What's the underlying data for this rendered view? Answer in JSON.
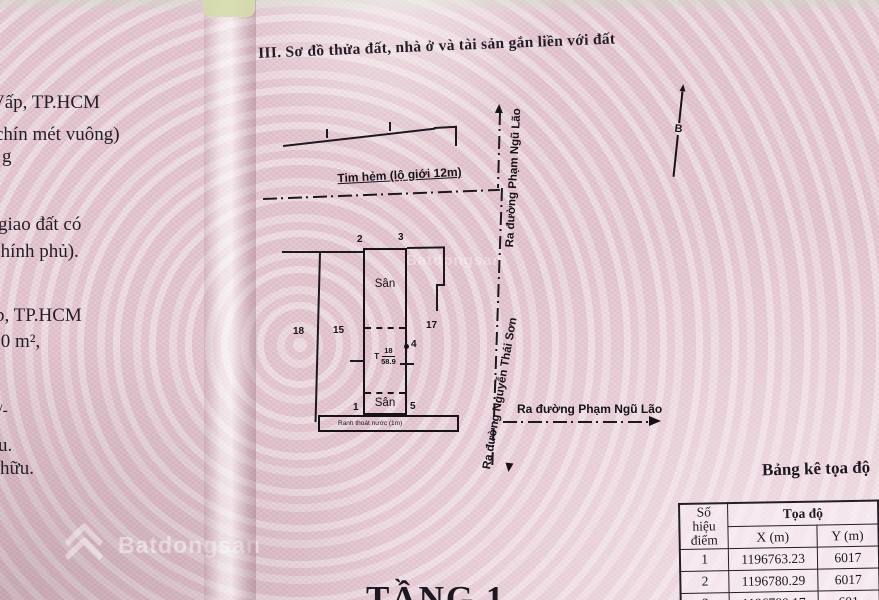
{
  "colors": {
    "paper_pink": "#e5cbd4",
    "fold_tab_green": "#d5dcab",
    "ink": "#1d1722",
    "watermark_white": "#ffffff"
  },
  "page": {
    "section_title": "III. Sơ đồ thửa đất, nhà ở và tài sản gắn liền với đất",
    "floor_label": "TẦNG 1"
  },
  "left_margin_fragments": [
    "Vấp, TP.HCM",
    "chín mét vuông)",
    "g",
    "giao đất có",
    "Chính phủ).",
    "p, TP.HCM",
    ",0 m²,",
    "/-",
    "u.",
    "hữu."
  ],
  "diagram": {
    "north_label": "B",
    "alley_label": "Tim hẻm (lộ giới 12m)",
    "road_up_label": "Ra đường Phạm Ngũ Lão",
    "road_down_label": "Ra đường Nguyễn Thái Sơn",
    "road_right_label": "Ra đường Phạm Ngũ Lão",
    "drain_label": "Ranh thoát nước (1m)",
    "parcel": {
      "vertex_1": "1",
      "vertex_2": "2",
      "vertex_3": "3",
      "vertex_4": "4",
      "vertex_5": "5",
      "yard_top": "Sân",
      "yard_bottom": "Sân",
      "ref_prefix": "T",
      "plot_number": "18",
      "plot_area": "58.9"
    },
    "neighbor_labels": [
      "18",
      "15",
      "17"
    ]
  },
  "watermarks": {
    "brand_top": "Batdongsan",
    "brand_bottom": "Batdongsan"
  },
  "coords_table": {
    "title": "Bảng kê tọa độ",
    "header_point_line1": "Số hiệu",
    "header_point_line2": "điểm",
    "header_coords": "Tọa độ",
    "header_x": "X (m)",
    "header_y": "Y (m)",
    "rows": [
      {
        "point": "1",
        "x": "1196763.23",
        "y": "6017"
      },
      {
        "point": "2",
        "x": "1196780.29",
        "y": "6017"
      },
      {
        "point": "3",
        "x": "1196780.17",
        "y": "601"
      }
    ]
  }
}
